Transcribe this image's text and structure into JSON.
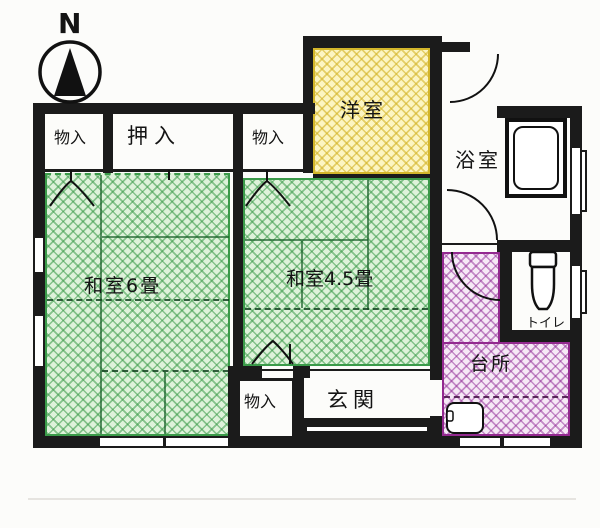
{
  "compass": {
    "label": "N"
  },
  "rooms": {
    "washitsu6": {
      "label": "和室6畳"
    },
    "washitsu45": {
      "label": "和室4.5畳"
    },
    "youshitsu": {
      "label": "洋室"
    },
    "bathroom": {
      "label": "浴室"
    },
    "kitchen": {
      "label": "台所"
    },
    "toilet": {
      "label": "トイレ"
    },
    "genkan": {
      "label": "玄関"
    },
    "oshiire": {
      "label": "押入"
    },
    "storage_top_left": {
      "label": "物入"
    },
    "storage_top_mid": {
      "label": "物入"
    },
    "storage_bottom": {
      "label": "物入"
    }
  },
  "colors": {
    "wall": "#1b1b1b",
    "tatami_fill": "#def2da",
    "tatami_line": "#3a9a49",
    "western_fill": "#fcf5c2",
    "western_line": "#d3b62b",
    "kitchen_fill": "#f6e9f6",
    "kitchen_line": "#93298f"
  }
}
